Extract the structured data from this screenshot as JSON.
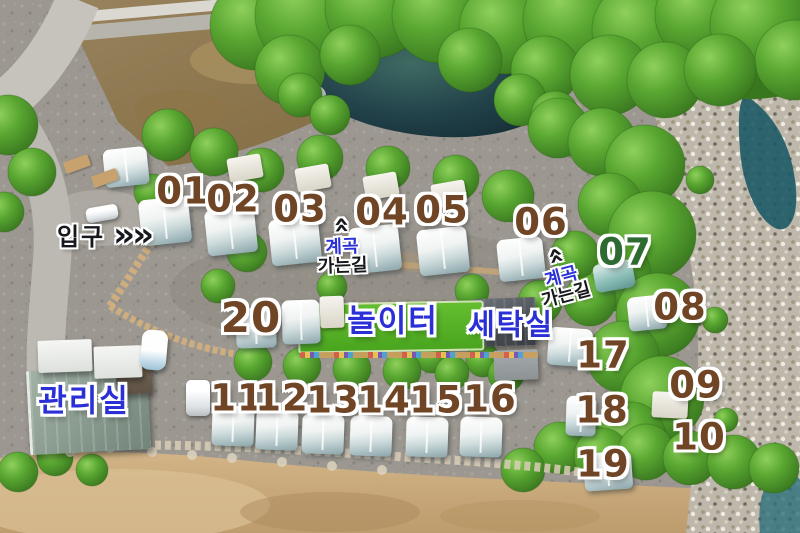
{
  "map": {
    "entrance": {
      "label": "입구",
      "arrow": "»"
    },
    "sites": [
      {
        "label": "01"
      },
      {
        "label": "02"
      },
      {
        "label": "03"
      },
      {
        "label": "04"
      },
      {
        "label": "05"
      },
      {
        "label": "06"
      },
      {
        "label": "07"
      },
      {
        "label": "08"
      },
      {
        "label": "09"
      },
      {
        "label": "10"
      },
      {
        "label": "11"
      },
      {
        "label": "12"
      },
      {
        "label": "13"
      },
      {
        "label": "14"
      },
      {
        "label": "15"
      },
      {
        "label": "16"
      },
      {
        "label": "17"
      },
      {
        "label": "18"
      },
      {
        "label": "19"
      },
      {
        "label": "20"
      }
    ],
    "facilities": {
      "playground": "놀이터",
      "laundry": "세탁실",
      "office": "관리실"
    },
    "valley_sign_top": {
      "chevron": "»",
      "line1": "계곡",
      "line2": "가는길"
    },
    "valley_sign_right": {
      "chevron": "»",
      "line1": "계곡",
      "line2": "가는길"
    },
    "colors": {
      "site_number_brown": "#6f4526",
      "site_number_green": "#2e6b33",
      "facility_blue": "#2a2fd6",
      "sign_dark": "#17181c"
    }
  }
}
